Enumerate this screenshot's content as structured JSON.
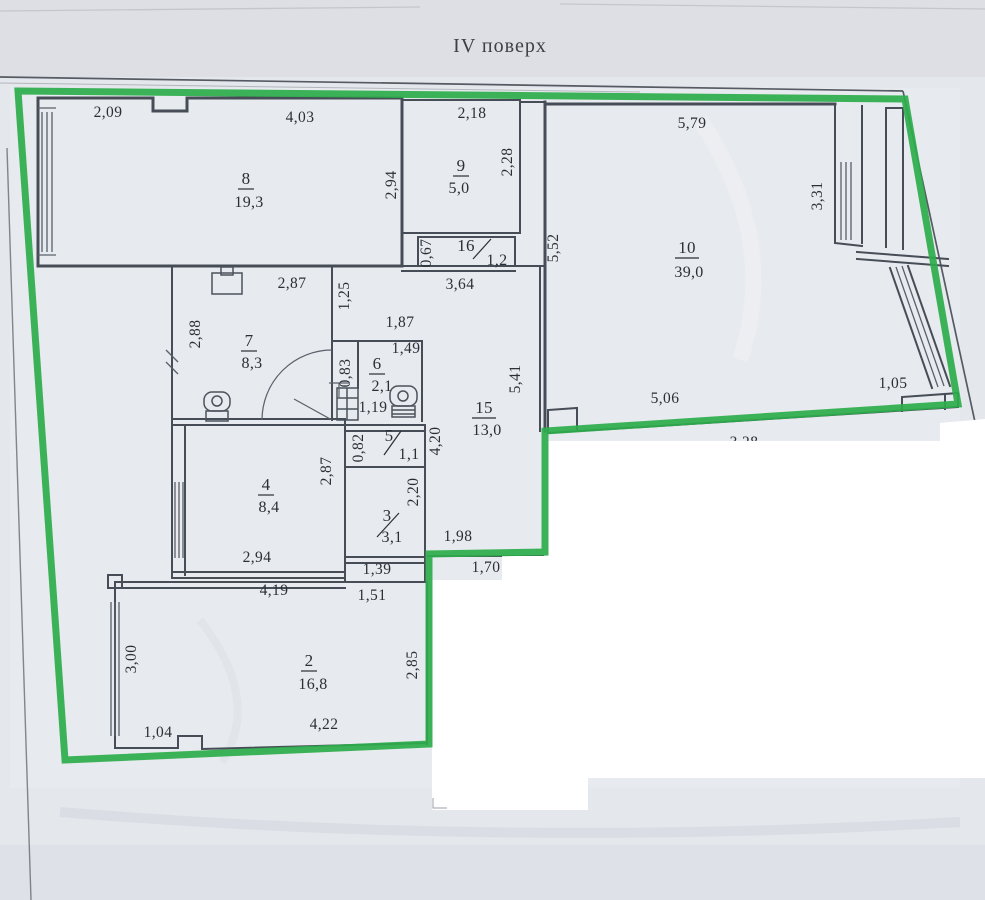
{
  "title": "IV поверх",
  "colors": {
    "outline_green": "#2dad4b",
    "wall_ink": "#474d57",
    "paper": "#e4e7ec",
    "paper_top": "#dddfe4",
    "mask_white": "#ffffff",
    "text_ink": "#2b2f36"
  },
  "rooms": [
    {
      "number": "8",
      "area": "19,3",
      "style": "frac",
      "nx": 246,
      "ny": 184,
      "ax": 249,
      "ay": 207
    },
    {
      "number": "9",
      "area": "5,0",
      "style": "frac",
      "nx": 461,
      "ny": 171,
      "ax": 459,
      "ay": 193
    },
    {
      "number": "16",
      "area": "1,2",
      "style": "slash",
      "nx": 466,
      "ny": 251,
      "ax": 497,
      "ay": 265,
      "slash": [
        473,
        259,
        491,
        239
      ]
    },
    {
      "number": "10",
      "area": "39,0",
      "style": "frac",
      "nx": 687,
      "ny": 253,
      "ax": 689,
      "ay": 277
    },
    {
      "number": "7",
      "area": "8,3",
      "style": "frac",
      "nx": 249,
      "ny": 346,
      "ax": 252,
      "ay": 368
    },
    {
      "number": "6",
      "area": "2,1",
      "style": "frac",
      "nx": 377,
      "ny": 369,
      "ax": 382,
      "ay": 391
    },
    {
      "number": "15",
      "area": "13,0",
      "style": "frac",
      "nx": 484,
      "ny": 413,
      "ax": 487,
      "ay": 435
    },
    {
      "number": "5",
      "area": "1,1",
      "style": "slash",
      "nx": 389,
      "ny": 441,
      "ax": 409,
      "ay": 459,
      "slash": [
        384,
        455,
        401,
        431
      ]
    },
    {
      "number": "4",
      "area": "8,4",
      "style": "frac",
      "nx": 266,
      "ny": 490,
      "ax": 269,
      "ay": 512
    },
    {
      "number": "3",
      "area": "3,1",
      "style": "slash",
      "nx": 387,
      "ny": 521,
      "ax": 392,
      "ay": 542,
      "slash": [
        377,
        537,
        399,
        513
      ]
    },
    {
      "number": "2",
      "area": "16,8",
      "style": "frac",
      "nx": 309,
      "ny": 666,
      "ax": 313,
      "ay": 689
    }
  ],
  "dimensions": [
    {
      "value": "2,09",
      "x": 108,
      "y": 117,
      "rotate": 0
    },
    {
      "value": "4,03",
      "x": 300,
      "y": 122,
      "rotate": 0
    },
    {
      "value": "2,18",
      "x": 472,
      "y": 118,
      "rotate": 0
    },
    {
      "value": "5,79",
      "x": 692,
      "y": 128,
      "rotate": 0
    },
    {
      "value": "2,94",
      "x": 396,
      "y": 185,
      "rotate": -90
    },
    {
      "value": "2,28",
      "x": 512,
      "y": 162,
      "rotate": -90
    },
    {
      "value": "3,31",
      "x": 822,
      "y": 196,
      "rotate": -90
    },
    {
      "value": "5,52",
      "x": 558,
      "y": 248,
      "rotate": -90
    },
    {
      "value": "0,67",
      "x": 431,
      "y": 253,
      "rotate": -90
    },
    {
      "value": "3,64",
      "x": 460,
      "y": 289,
      "rotate": 0
    },
    {
      "value": "1,25",
      "x": 349,
      "y": 296,
      "rotate": -90
    },
    {
      "value": "2,87",
      "x": 292,
      "y": 288,
      "rotate": 0
    },
    {
      "value": "2,88",
      "x": 200,
      "y": 334,
      "rotate": -90
    },
    {
      "value": "1,87",
      "x": 400,
      "y": 327,
      "rotate": 0
    },
    {
      "value": "1,49",
      "x": 406,
      "y": 353,
      "rotate": 0
    },
    {
      "value": "0,83",
      "x": 350,
      "y": 373,
      "rotate": -90
    },
    {
      "value": "1,19",
      "x": 373,
      "y": 412,
      "rotate": 0
    },
    {
      "value": "5,41",
      "x": 520,
      "y": 379,
      "rotate": -90
    },
    {
      "value": "4,20",
      "x": 440,
      "y": 441,
      "rotate": -90
    },
    {
      "value": "0,82",
      "x": 363,
      "y": 448,
      "rotate": -90
    },
    {
      "value": "2,87",
      "x": 331,
      "y": 471,
      "rotate": -90
    },
    {
      "value": "2,20",
      "x": 418,
      "y": 492,
      "rotate": -90
    },
    {
      "value": "5,06",
      "x": 665,
      "y": 403,
      "rotate": 0
    },
    {
      "value": "1,05",
      "x": 893,
      "y": 388,
      "rotate": 0
    },
    {
      "value": "3,28",
      "x": 744,
      "y": 447,
      "rotate": 0
    },
    {
      "value": "2,94",
      "x": 257,
      "y": 562,
      "rotate": 0
    },
    {
      "value": "1,98",
      "x": 458,
      "y": 541,
      "rotate": 0
    },
    {
      "value": "1,39",
      "x": 377,
      "y": 574,
      "rotate": 0
    },
    {
      "value": "1,51",
      "x": 372,
      "y": 600,
      "rotate": 0
    },
    {
      "value": "4,19",
      "x": 274,
      "y": 595,
      "rotate": 0
    },
    {
      "value": "1,70",
      "x": 486,
      "y": 572,
      "rotate": 0
    },
    {
      "value": "3,00",
      "x": 136,
      "y": 659,
      "rotate": -90
    },
    {
      "value": "2,85",
      "x": 417,
      "y": 665,
      "rotate": -90
    },
    {
      "value": "1,04",
      "x": 158,
      "y": 737,
      "rotate": 0
    },
    {
      "value": "4,22",
      "x": 324,
      "y": 729,
      "rotate": 0
    }
  ]
}
